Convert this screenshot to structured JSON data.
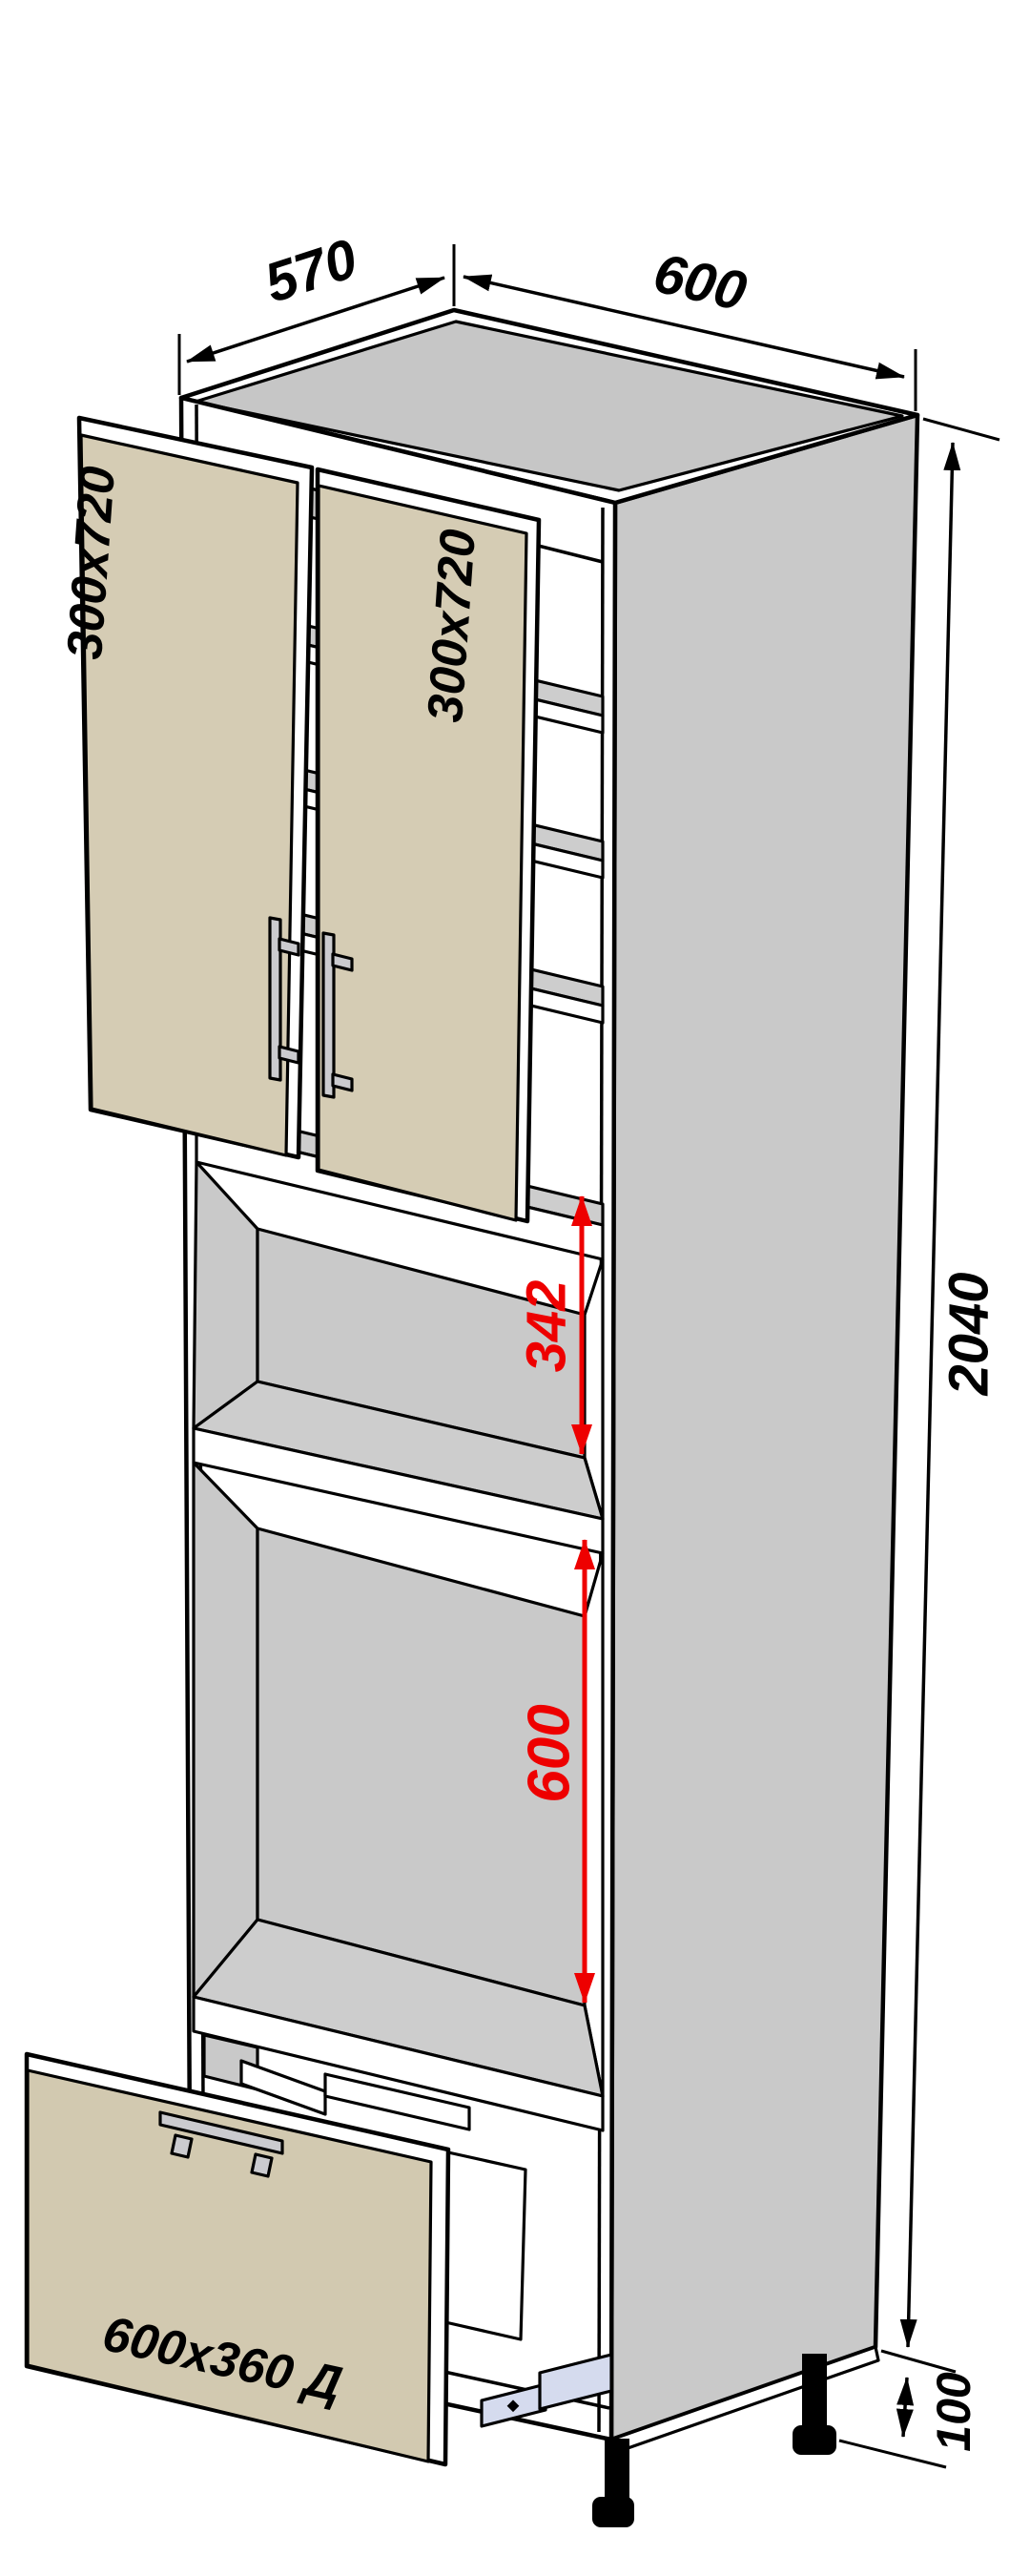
{
  "diagram": {
    "type": "furniture-assembly-drawing",
    "product": "tall-kitchen-cabinet-with-niches-and-drawer",
    "background": "#ffffff",
    "colors": {
      "outline": "#000000",
      "dimension_text": "#000000",
      "highlight_red": "#ee0000",
      "facade_beige": "#d5ccb4",
      "drawer_beige": "#d2c9b0",
      "carcass_gray": "#c9c9c9",
      "top_gray": "#c6c6c6",
      "shelf_gray": "#cdcdcd",
      "rail_lavender": "#d5dbee",
      "handle_silver": "#cbcbcf",
      "legs_black": "#000000"
    },
    "dimensions": {
      "depth_top": "570",
      "width_top": "600",
      "height_right": "2040",
      "legs_right": "100",
      "niche_middle": "342",
      "niche_lower": "600"
    },
    "labels": {
      "door_left": "300x720",
      "door_right": "300x720",
      "drawer_front": "600x360 Д"
    }
  }
}
